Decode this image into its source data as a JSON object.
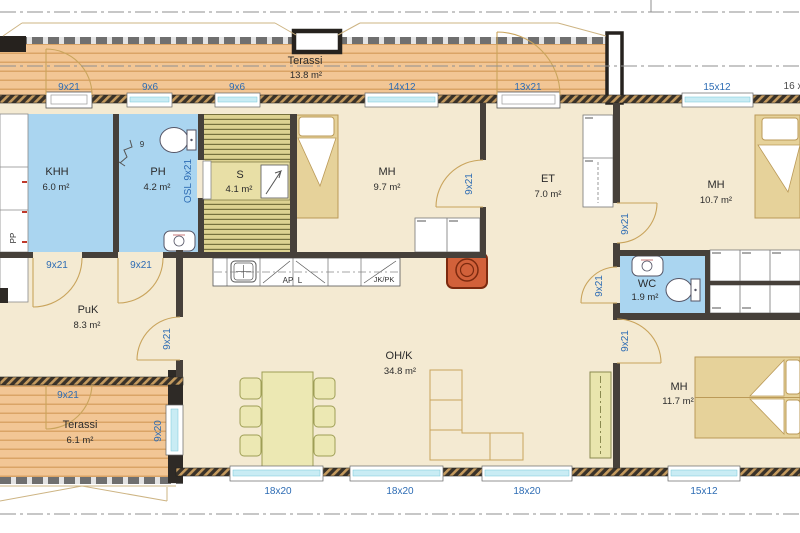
{
  "title": "Floor plan",
  "rooms": [
    {
      "name": "Terassi",
      "area": "13.8 m²"
    },
    {
      "name": "KHH",
      "area": "6.0 m²"
    },
    {
      "name": "PH",
      "area": "4.2 m²"
    },
    {
      "name": "S",
      "area": "4.1 m²"
    },
    {
      "name": "MH",
      "area": "9.7 m²"
    },
    {
      "name": "ET",
      "area": "7.0 m²"
    },
    {
      "name": "MH",
      "area": "10.7 m²"
    },
    {
      "name": "PuK",
      "area": "8.3 m²"
    },
    {
      "name": "OH/K",
      "area": "34.8 m²"
    },
    {
      "name": "WC",
      "area": "1.9 m²"
    },
    {
      "name": "MH",
      "area": "11.7 m²"
    },
    {
      "name": "Terassi",
      "area": "6.1 m²"
    }
  ],
  "op_top": [
    "9x21",
    "9x6",
    "9x6",
    "14x12",
    "13x21",
    "15x12"
  ],
  "op_bottom": [
    "18x20",
    "18x20",
    "18x20",
    "15x12"
  ],
  "doors": {
    "standard": "9x21",
    "sauna": "OSL 9x21",
    "window9x20": "9x20"
  },
  "kitchen": {
    "ap": "AP",
    "l": "L",
    "jkpk": "JK/PK"
  },
  "notes": {
    "pp": "PP",
    "drain": "9",
    "edge": "16 x"
  },
  "colors": {
    "floor": "#f4ead2",
    "wet_room": "#aad5f0",
    "deck": "#f2c695",
    "sauna": "#ddd291",
    "wall": "#46403a",
    "label_blue": "#2d6cb4",
    "fireplace": "#d2613a",
    "furniture": "#ece8b3",
    "glass": "#c9ecf4"
  }
}
